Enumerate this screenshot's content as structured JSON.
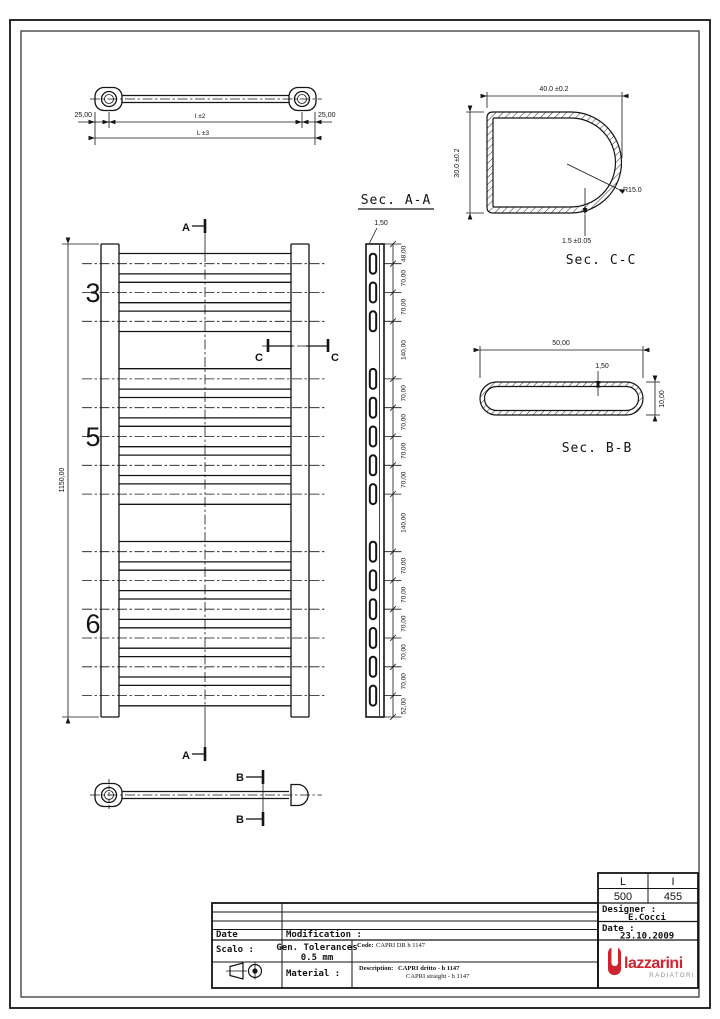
{
  "top_view": {
    "dim_left": "25,00",
    "dim_right": "25,00",
    "dim_interaxis": "I ±2",
    "dim_overall": "L ±3"
  },
  "front_view": {
    "dim_height": "1150,00",
    "group_labels": [
      "3",
      "5",
      "6"
    ],
    "rung_centers_mm": [
      48,
      118,
      188,
      328,
      398,
      468,
      538,
      608,
      748,
      818,
      888,
      958,
      1028,
      1098
    ],
    "marker_a": "A",
    "marker_b": "B",
    "marker_c": "C"
  },
  "sec_aa": {
    "title": "Sec. A-A",
    "dim_wall": "1,50",
    "segment_mm": [
      0,
      48,
      118,
      188,
      328,
      398,
      468,
      538,
      608,
      748,
      818,
      888,
      958,
      1028,
      1098,
      1150
    ],
    "segment_dims": [
      "48,00",
      "70,00",
      "70,00",
      "140,00",
      "70,00",
      "70,00",
      "70,00",
      "70,00",
      "140,00",
      "70,00",
      "70,00",
      "70,00",
      "70,00",
      "70,00",
      "52,00"
    ]
  },
  "sec_bb": {
    "title": "Sec. B-B",
    "dim_width": "50,00",
    "dim_wall": "1,50",
    "dim_height": "10,00"
  },
  "sec_cc": {
    "title": "Sec. C-C",
    "dim_width": "40.0 ±0.2",
    "dim_height": "30.0 ±0.2",
    "dim_radius": "R15.0",
    "dim_wall": "1.5 ±0.05"
  },
  "title_block": {
    "date_label": "Date",
    "modification_label": "Modification :",
    "scale_label": "Scalo :",
    "tolerances_label": "Gen. Tolerances",
    "tolerances_value": "0.5 mm",
    "material_label": "Material :",
    "code_label": "Code:",
    "code_value": "CAPRI DR h 1147",
    "description_label": "Description:",
    "description_value": "CAPRI dritto - h 1147",
    "description_value2": "CAPRI straight - h 1147",
    "col_l_label": "L",
    "col_i_label": "I",
    "col_l_value": "500",
    "col_i_value": "455",
    "designer_label": "Designer :",
    "designer_value": "E.Cocci",
    "date2_label": "Date :",
    "date_value": "23.10.2009",
    "logo_text": "lazzarini",
    "logo_sub": "RADIATORI",
    "logo_color": "#cf2330"
  }
}
